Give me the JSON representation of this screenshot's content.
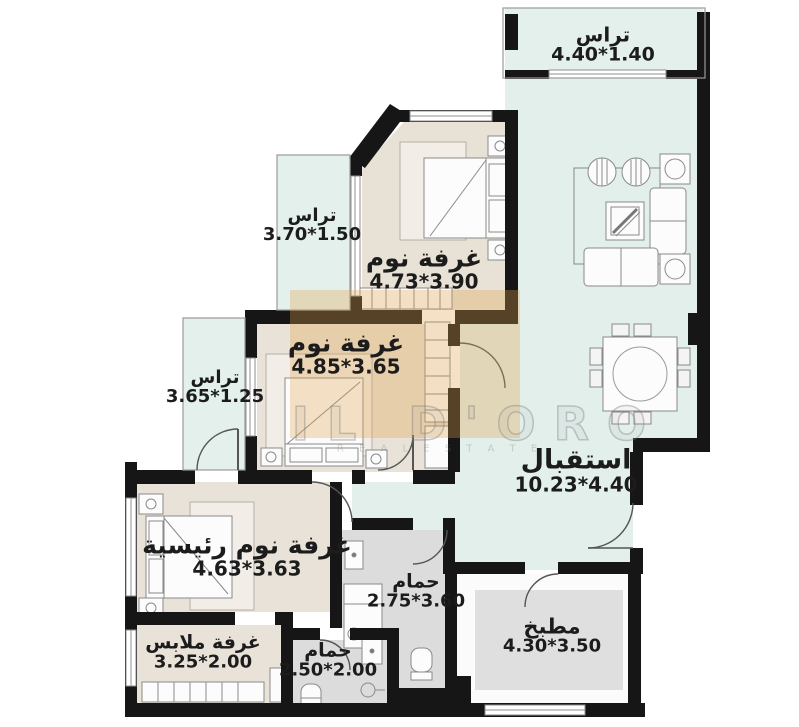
{
  "title": "apartment-floor-plan",
  "watermark": {
    "brand": "IL D'ORO",
    "subtext": "R E A L   E S T A T E"
  },
  "colors": {
    "wall": "#161616",
    "terrace_floor": "#e3efeb",
    "bedroom_floor": "#e9e2d8",
    "wet_floor": "#dcdcdc",
    "watermark_tan": "#dfa44d"
  },
  "rooms": [
    {
      "id": "terrace-top",
      "name": "تراس",
      "dims": "4.40*1.40"
    },
    {
      "id": "terrace-upper-left",
      "name": "تراس",
      "dims": "3.70*1.50"
    },
    {
      "id": "bedroom-1",
      "name": "غرفة نوم",
      "dims": "4.73*3.90"
    },
    {
      "id": "bedroom-2",
      "name": "غرفة نوم",
      "dims": "4.85*3.65"
    },
    {
      "id": "terrace-lower-left",
      "name": "تراس",
      "dims": "3.65*1.25"
    },
    {
      "id": "reception",
      "name": "استقبال",
      "dims": "10.23*4.40"
    },
    {
      "id": "master-bedroom",
      "name": "غرفة نوم رئيسية",
      "dims": "4.63*3.63"
    },
    {
      "id": "dressing-room",
      "name": "غرفة ملابس",
      "dims": "3.25*2.00"
    },
    {
      "id": "bathroom-1",
      "name": "حمام",
      "dims": "2.75*3.60"
    },
    {
      "id": "bathroom-2",
      "name": "حمام",
      "dims": "2.50*2.00"
    },
    {
      "id": "kitchen",
      "name": "مطبخ",
      "dims": "4.30*3.50"
    }
  ]
}
